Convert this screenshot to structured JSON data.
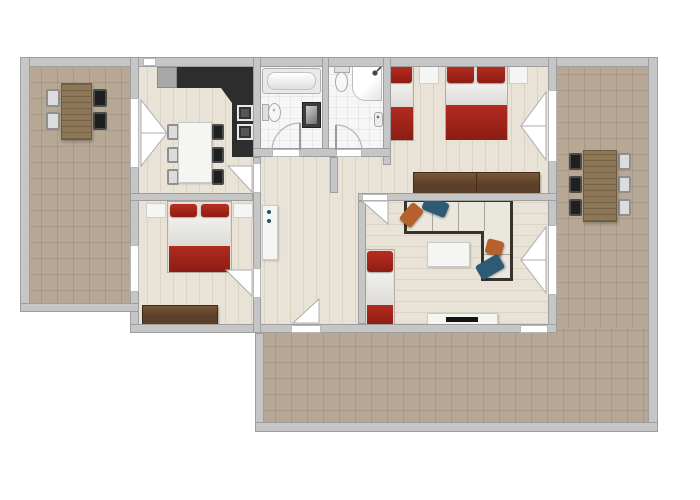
{
  "scene": {
    "type": "apartment-floor-plan",
    "view": "top-down",
    "text_labels": []
  },
  "colors": {
    "wall": "#c6c6c6",
    "wall-border": "#9e9e9e",
    "wood-floor": "#e9e3d7",
    "terrace-floor": "#b6a895",
    "bath-floor": "#f6f6f6",
    "counter": "#2d2d2d",
    "fridge-gray": "#a8a8a8",
    "bed-red": "#b22b20",
    "bed-red-dark": "#8c1d14",
    "wardrobe": "#5b3f28",
    "wardrobe-light": "#7a5737",
    "table-wood": "#8d7757",
    "sofa-frame": "#37322c",
    "sofa-cushion": "#eae7df",
    "pillow-orange": "#b5602d",
    "pillow-blue": "#2d5a75",
    "white-furniture": "#f5f5f3",
    "opening": "#ffffff",
    "opening-border": "#b8b8b8",
    "cabinet-dot": "#1d5560",
    "tv-black": "#141414"
  },
  "rooms": [
    {
      "name": "left-terrace",
      "furniture": [
        "dining-table-wood",
        "chair x4"
      ]
    },
    {
      "name": "kitchen-dining",
      "furniture": [
        "kitchen-counter-L",
        "fridge",
        "sink",
        "cooktop",
        "dining-table",
        "chair x6",
        "french-door-to-terrace"
      ]
    },
    {
      "name": "bathroom",
      "furniture": [
        "bathtub",
        "toilet",
        "vanity-sink",
        "door-swing"
      ]
    },
    {
      "name": "shower-room",
      "furniture": [
        "toilet",
        "shower",
        "hand-sink",
        "door-swing"
      ]
    },
    {
      "name": "bedroom-top-right",
      "furniture": [
        "single-bed",
        "double-bed",
        "nightstand x2",
        "wardrobe",
        "french-door-to-terrace"
      ]
    },
    {
      "name": "bedroom-left",
      "furniture": [
        "double-bed",
        "nightstand x2",
        "wardrobe",
        "window",
        "door-swing"
      ]
    },
    {
      "name": "hallway",
      "furniture": [
        "tall-cabinet",
        "door-to-bottom-terrace"
      ]
    },
    {
      "name": "living-room",
      "furniture": [
        "corner-sofa",
        "throw-pillow x4",
        "coffee-table",
        "tv-stand",
        "tv",
        "single-bed",
        "french-door-to-terrace",
        "window"
      ]
    },
    {
      "name": "right-terrace",
      "furniture": [
        "dining-table-wood",
        "chair x6"
      ]
    },
    {
      "name": "bottom-terrace",
      "furniture": []
    }
  ]
}
